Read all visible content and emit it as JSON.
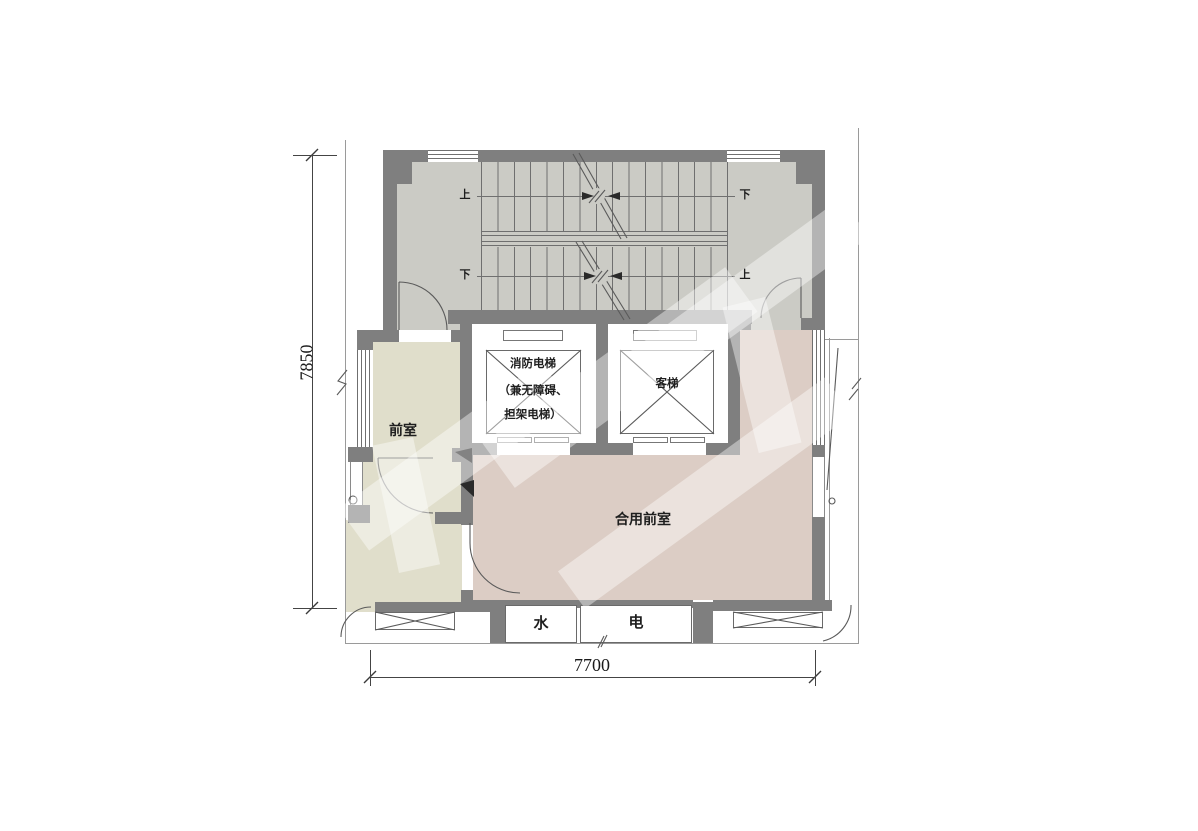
{
  "plan": {
    "rooms": {
      "front_room": "前室",
      "shared_front_room": "合用前室"
    },
    "elevators": {
      "fire": {
        "line1": "消防电梯",
        "line2": "（兼无障碍、",
        "line3": "担架电梯）"
      },
      "passenger": "客梯"
    },
    "shafts": {
      "water": "水",
      "electricity": "电"
    },
    "stair": {
      "up": "上",
      "down": "下"
    },
    "dimensions": {
      "vertical": "7850",
      "horizontal": "7700"
    },
    "colors": {
      "wall": "#7f7f7f",
      "stair_floor": "#cbcbc5",
      "front_room_fill": "#e0decb",
      "shared_front_room_fill": "#dccdc5",
      "line": "#6f6f6f",
      "text": "#1e1e1e"
    }
  }
}
